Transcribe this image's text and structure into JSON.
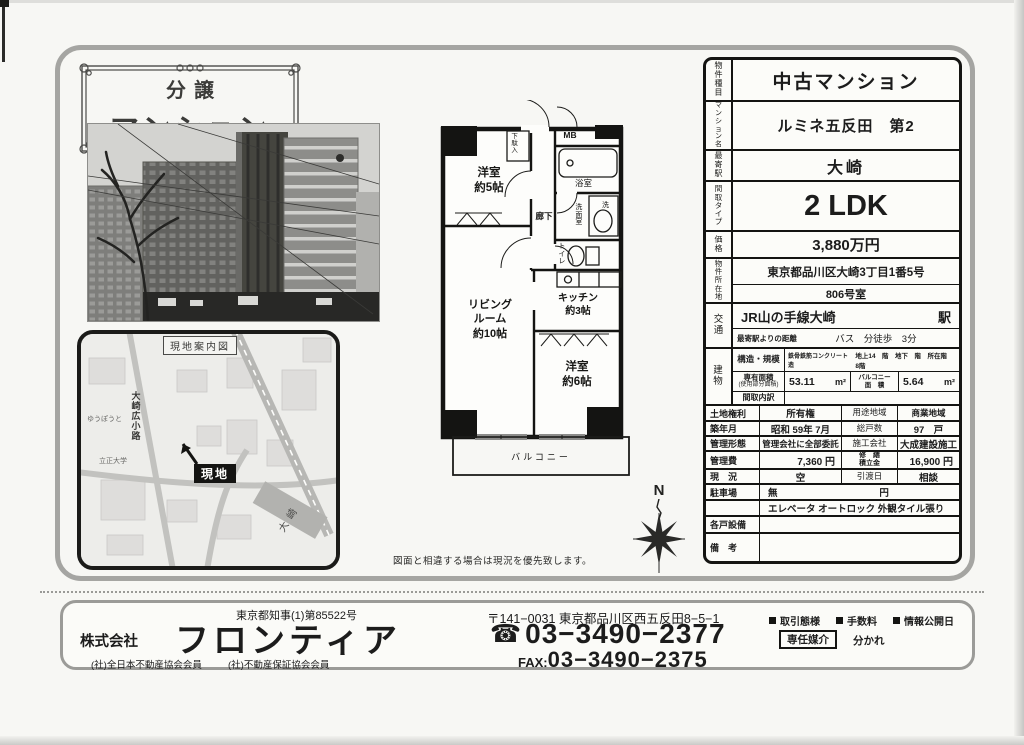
{
  "badge": {
    "line1": "分譲",
    "line2": "マンション"
  },
  "map": {
    "title": "現地案内図",
    "site_label": "現地",
    "station_label": "大崎",
    "street_label": "大崎広小路",
    "poi_university": "立正大学",
    "poi_hall": "ゆうぽうと"
  },
  "floorplan": {
    "shoebox": "下駄入",
    "mb": "MB",
    "bath": "浴室",
    "washroom": "洗面室",
    "washer": "洗",
    "toilet": "トイレ",
    "corridor": "廊下",
    "bedroom5_name": "洋室",
    "bedroom5_size": "約5帖",
    "living_l1": "リビング",
    "living_l2": "ルーム",
    "living_l3": "約10帖",
    "kitchen_name": "キッチン",
    "kitchen_size": "約3帖",
    "bedroom6_name": "洋室",
    "bedroom6_size": "約6帖",
    "balcony": "バルコニー",
    "compass_n": "N",
    "note": "図面と相違する場合は現況を優先致します。"
  },
  "spec": {
    "type_label": "物件種目",
    "type_value": "中古マンション",
    "name_label": "マンション名",
    "name_value": "ルミネ五反田　第2",
    "station_label": "最寄駅",
    "station_value": "大崎",
    "layout_label": "間取タイプ",
    "layout_value": "2 LDK",
    "price_label": "価格",
    "price_value": "3,880万円",
    "address_label": "物件所在地",
    "address_value": "東京都品川区大崎3丁目1番5号",
    "room_value": "806号室",
    "access_label": "交通",
    "access_line": "JR山の手線大崎",
    "access_suffix": "駅",
    "distance_label": "最寄駅よりの距離",
    "distance_value": "バス　分徒歩　3分",
    "building_label": "建物",
    "structure_label": "構造・規模",
    "structure_value": "鉄骨鉄筋コンクリート造",
    "structure_floors": "地上14　階　地下　階　所在階　8階",
    "area_label": "専有面積",
    "area_sublabel": "(使用部分面積)",
    "area_value": "53.11",
    "area_unit": "m²",
    "balcony_label_l1": "バルコニー",
    "balcony_label_l2": "面　積",
    "balcony_value": "5.64",
    "balcony_unit": "m²",
    "madori_label": "間取内訳",
    "madori_value": "",
    "land_label": "土地権利",
    "land_value": "所有権",
    "zoning_label": "用途地域",
    "zoning_value": "商業地域",
    "built_label": "築年月",
    "built_value": "昭和 59年 7月",
    "units_label": "総戸数",
    "units_value": "97　戸",
    "mgmt_label": "管理形態",
    "mgmt_value": "管理会社に全部委託",
    "constructor_label": "施工会社",
    "constructor_value": "大成建設施工",
    "fee_label": "管理費",
    "fee_value": "7,360 円",
    "repair_label_l1": "修　繕",
    "repair_label_l2": "積立金",
    "repair_value": "16,900 円",
    "status_label": "現　況",
    "status_value": "空",
    "handover_label": "引渡日",
    "handover_value": "相談",
    "parking_label": "駐車場",
    "parking_value": "無",
    "parking_unit": "円",
    "features_value": "エレベータ オートロック 外観タイル張り",
    "equipment_label": "各戸設備",
    "equipment_value": "",
    "remarks_label": "備　考",
    "remarks_value": ""
  },
  "footer": {
    "license": "東京都知事(1)第85522号",
    "company_prefix": "株式会社",
    "company_name": "フロンティア",
    "member1": "(社)全日本不動産協会会員",
    "member2": "(社)不動産保証協会会員",
    "postal_address": "〒141−0031 東京都品川区西五反田8−5−1",
    "phone_icon": "☎",
    "phone": "03−3490−2377",
    "fax_label": "FAX:",
    "fax": "03−3490−2375",
    "deal_label": "取引態様",
    "fee_label": "手数料",
    "info_label": "情報公開日",
    "deal_value": "専任媒介",
    "fee_value": "分かれ"
  }
}
